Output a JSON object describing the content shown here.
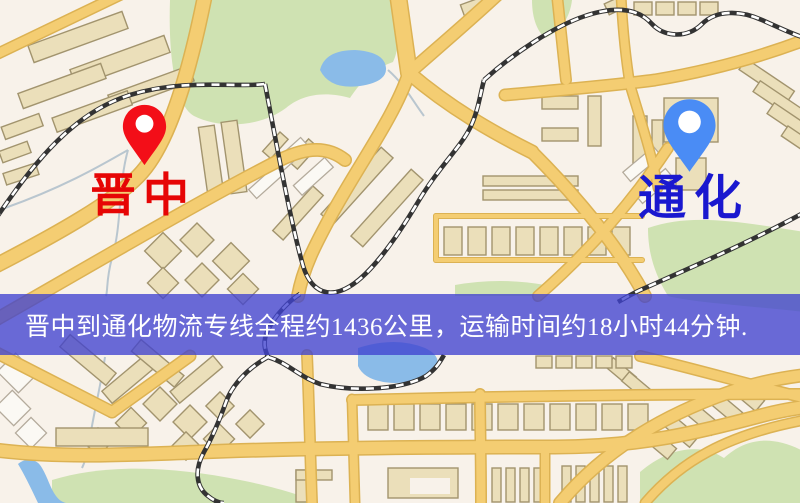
{
  "banner": {
    "text": "晋中到通化物流专线全程约1436公里，运输时间约18小时44分钟.",
    "background_color": "#4042d0",
    "text_color": "#ffffff"
  },
  "route": {
    "origin": "晋中",
    "destination": "通化",
    "distance_text": "约1436公里",
    "duration_text": "约18小时44分钟"
  },
  "markers": {
    "origin": {
      "label": "晋中",
      "pin_color": "#f30e18",
      "label_color": "#e60505"
    },
    "destination": {
      "label": "通化",
      "pin_color": "#4a8cf5",
      "label_color": "#1a18cf"
    }
  },
  "map_colors": {
    "base": "#f8f2ea",
    "road_fill": "#f4cd72",
    "road_border": "#dcb253",
    "railway": "#333333",
    "park_green": "#cfe2b2",
    "water_blue": "#8abbe8",
    "building_tan": "#ebdfba",
    "building_outline": "#a2946e"
  }
}
